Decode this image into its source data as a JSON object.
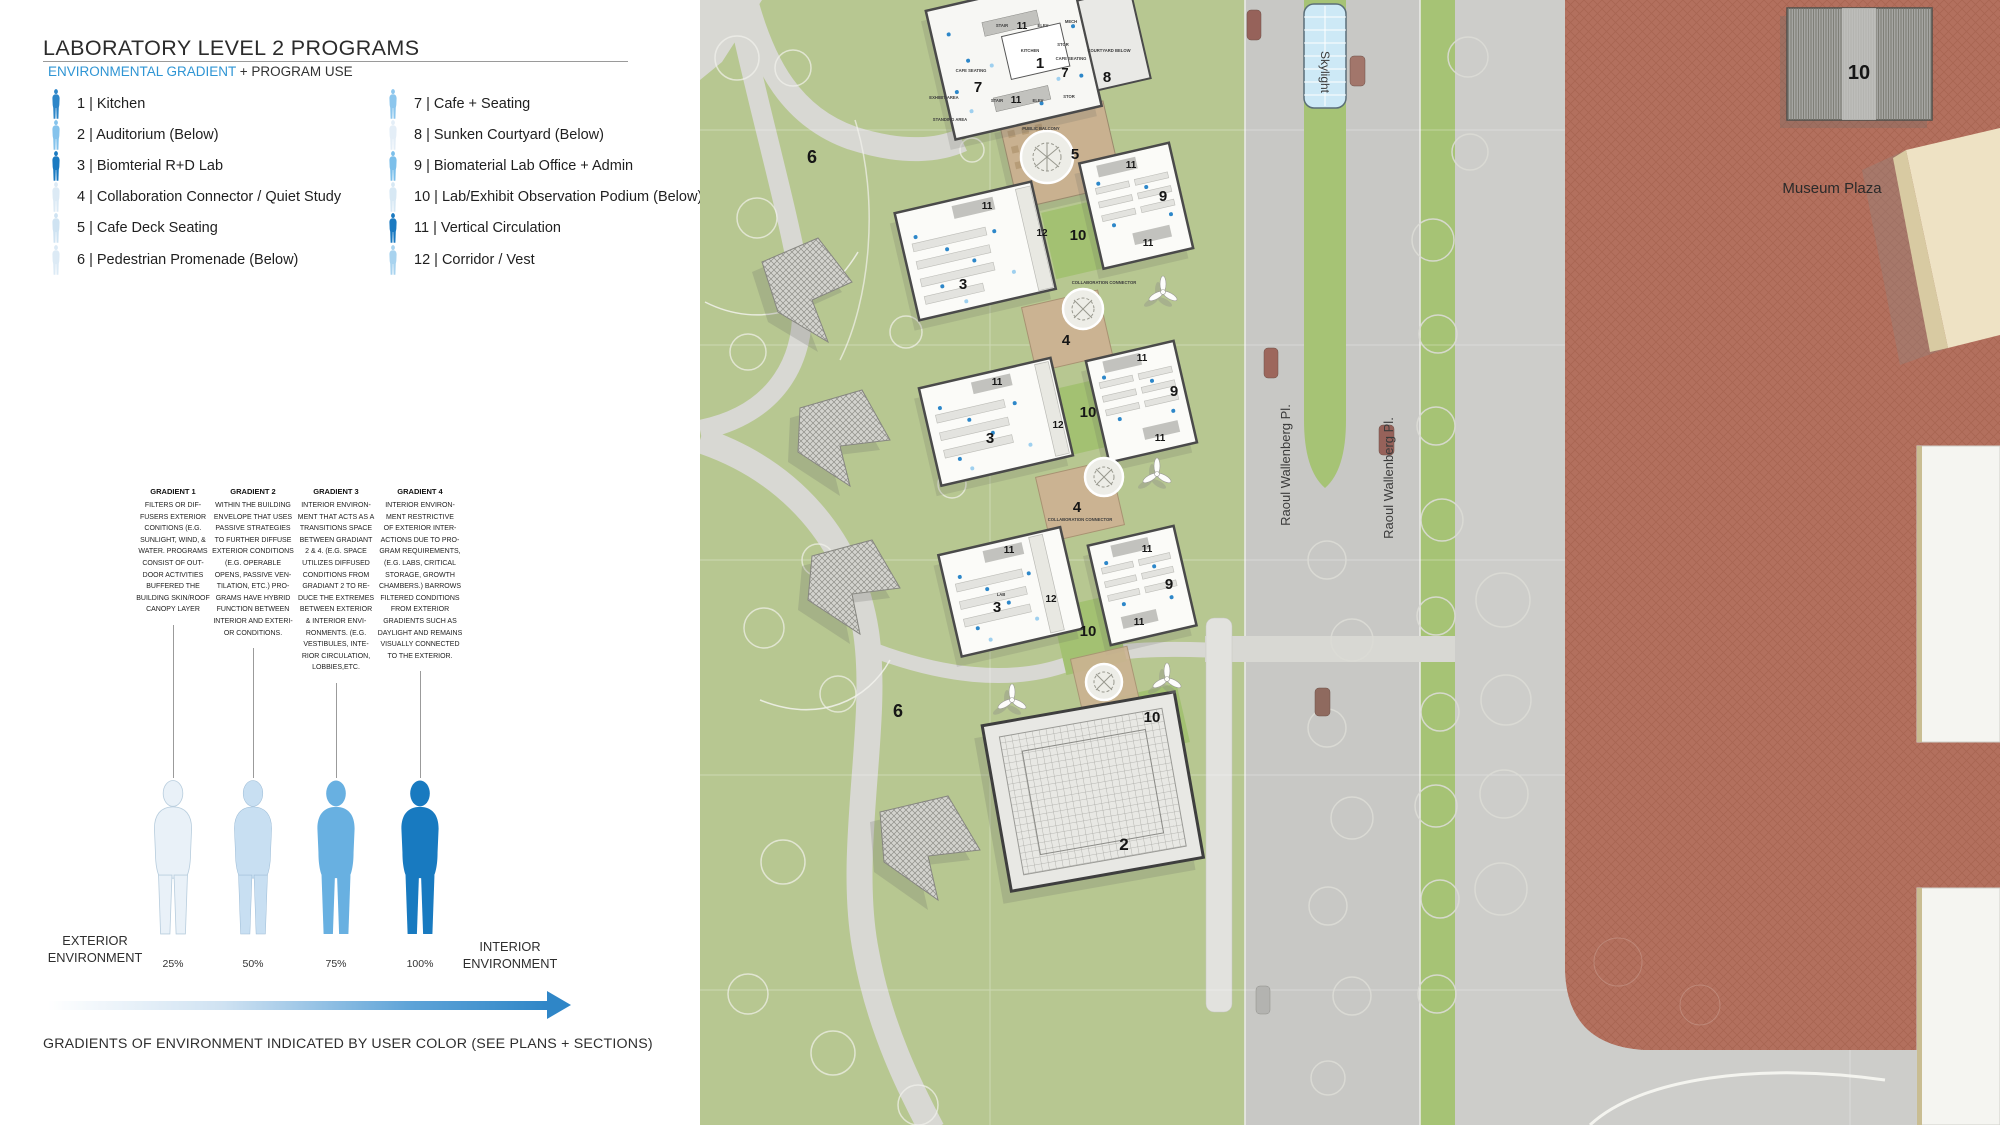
{
  "panel": {
    "title": "LABORATORY LEVEL 2 PROGRAMS",
    "subtitle": {
      "highlight": "ENVIRONMENTAL GRADIENT",
      "rest": " + PROGRAM USE"
    },
    "legend": {
      "items": [
        {
          "label": "1 | Kitchen",
          "color": "#2e86c8"
        },
        {
          "label": "2 | Auditorium (Below)",
          "color": "#85c3ec"
        },
        {
          "label": "3 | Biomterial R+D Lab",
          "color": "#1b7ac1"
        },
        {
          "label": "4 | Collaboration Connector / Quiet Study",
          "color": "#dceaf5"
        },
        {
          "label": "5 | Cafe Deck Seating",
          "color": "#cfe3f2"
        },
        {
          "label": "6 | Pedestrian Promenade (Below)",
          "color": "#dceaf5"
        },
        {
          "label": "7 | Cafe + Seating",
          "color": "#8cc6ed"
        },
        {
          "label": "8 | Sunken Courtyard (Below)",
          "color": "#e4eef7"
        },
        {
          "label": "9 | Biomaterial Lab Office + Admin",
          "color": "#7cbfea"
        },
        {
          "label": "10 | Lab/Exhibit Observation Podium (Below)",
          "color": "#d7e8f4"
        },
        {
          "label": "11 | Vertical Circulation",
          "color": "#1b7ac1"
        },
        {
          "label": "12 | Corridor / Vest",
          "color": "#a8d3ef"
        }
      ]
    },
    "gradients": [
      {
        "title": "GRADIENT 1",
        "body": "FILTERS OR DIF-\nFUSERS EXTERIOR\nCONITIONS (E.G.\nSUNLIGHT, WIND, &\nWATER. PROGRAMS\nCONSIST OF OUT-\nDOOR ACTIVITIES\nBUFFERED THE\nBUILDING SKIN/ROOF\nCANOPY LAYER"
      },
      {
        "title": "GRADIENT 2",
        "body": "WITHIN THE BUILDING\nENVELOPE THAT USES\nPASSIVE STRATEGIES\nTO FURTHER DIFFUSE\nEXTERIOR CONDITIONS\n(E.G. OPERABLE\nOPENS, PASSIVE VEN-\nTILATION, ETC.) PRO-\nGRAMS HAVE HYBRID\nFUNCTION BETWEEN\nINTERIOR AND EXTERI-\nOR CONDITIONS."
      },
      {
        "title": "GRADIENT 3",
        "body": "INTERIOR ENVIRON-\nMENT THAT ACTS AS A\nTRANSITIONS SPACE\nBETWEEN GRADIANT\n2 & 4. (E.G. SPACE\nUTILIZES DIFFUSED\nCONDITIONS FROM\nGRADIANT 2 TO RE-\nDUCE THE EXTREMES\nBETWEEN EXTERIOR\n& INTERIOR ENVI-\nRONMENTS. (E.G.\nVESTIBULES, INTE-\nRIOR CIRCULATION,\nLOBBIES,ETC."
      },
      {
        "title": "GRADIENT 4",
        "body": "INTERIOR ENVIRON-\nMENT RESTRICTIVE\nOF EXTERIOR INTER-\nACTIONS DUE TO PRO-\nGRAM REQUIREMENTS,\n(E.G. LABS, CRITICAL\nSTORAGE, GROWTH\nCHAMBERS.) BARROWS\nFILTERED CONDITIONS\nFROM EXTERIOR\nGRADIENTS SUCH AS\nDAYLIGHT AND REMAINS\nVISUALLY CONNECTED\nTO THE EXTERIOR."
      }
    ],
    "scale": {
      "percents": [
        "25%",
        "50%",
        "75%",
        "100%"
      ],
      "figure_colors": [
        "#e9f1f8",
        "#c8dff2",
        "#68b0e1",
        "#187ac0"
      ],
      "exterior_label": "EXTERIOR\nENVIRONMENT",
      "interior_label": "INTERIOR\nENVIRONMENT"
    },
    "caption": "GRADIENTS OF ENVIRONMENT INDICATED BY USER COLOR (SEE PLANS + SECTIONS)"
  },
  "site_plan": {
    "streets": {
      "skylight": "Skylight",
      "raoul_wallenberg_1": "Raoul Wallenberg Pl.",
      "raoul_wallenberg_2": "Raoul Wallenberg Pl.",
      "museum_plaza": "Museum Plaza"
    },
    "numbers": [
      "6",
      "11",
      "7",
      "1",
      "7",
      "8",
      "11",
      "5",
      "11",
      "9",
      "11",
      "11",
      "12",
      "3",
      "10",
      "4",
      "11",
      "12",
      "3",
      "11",
      "9",
      "11",
      "10",
      "4",
      "11",
      "12",
      "3",
      "11",
      "9",
      "11",
      "10",
      "10",
      "2",
      "6",
      "10"
    ],
    "rooms": [
      "STAIR",
      "ELEV",
      "MECH",
      "KITCHEN",
      "STOR",
      "CAFE SEATING",
      "CAFE SEATING",
      "COURTYARD BELOW",
      "STAIR",
      "ELEV",
      "STOR",
      "EXHIBIT AREA",
      "STANDING AREA",
      "PUBLIC BALCONY",
      "COLLABORATION CONNECTOR",
      "COLLABORATION CONNECTOR",
      "LAB"
    ]
  },
  "colors": {
    "accent_blue": "#2f95d4",
    "park_green": "#b7c791",
    "roof_green": "#a3c172",
    "road_gray": "#c8c8c5",
    "plaza_red": "#b3705e",
    "deck_tan": "#cbb392"
  }
}
